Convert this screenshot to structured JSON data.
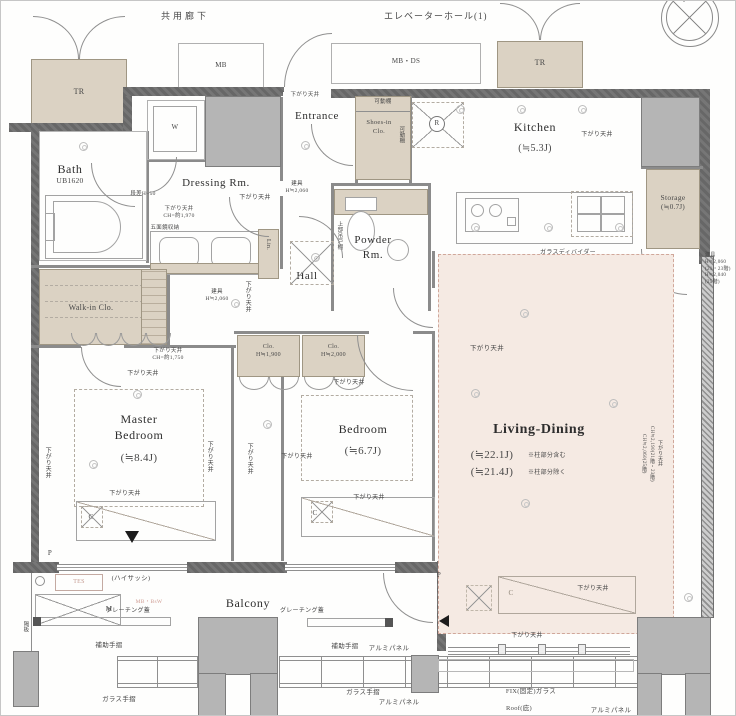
{
  "areas": {
    "common_corridor": "共用廊下",
    "elevator_hall": "エレベーターホール(1)"
  },
  "rooms": {
    "bath_name": "Bath",
    "bath_model": "UB1620",
    "dressing": "Dressing Rm.",
    "entrance": "Entrance",
    "shoes": "Shoes-in\nClo.",
    "powder": "Powder\nRm.",
    "hall": "Hall",
    "kitchen_name": "Kitchen",
    "kitchen_size": "(≒5.3J)",
    "storage_name": "Storage",
    "storage_size": "(≒0.7J)",
    "living_name": "Living-Dining",
    "living_size_incl": "(≒22.1J)",
    "living_note_incl": "※柱部分含む",
    "living_size_excl": "(≒21.4J)",
    "living_note_excl": "※柱部分除く",
    "master_name": "Master\nBedroom",
    "master_size": "(≒8.4J)",
    "bedroom_name": "Bedroom",
    "bedroom_size": "(≒6.7J)",
    "walkin": "Walk-in Clo.",
    "balcony": "Balcony",
    "clo_a": "Clo.\nH≒1,900",
    "clo_b": "Clo.\nH≒2,000"
  },
  "marks": {
    "tr": "TR",
    "mb": "MB",
    "mb_ds": "MB・DS",
    "w": "W",
    "r": "R",
    "m": "M",
    "c": "C",
    "p": "P",
    "tes": "TES",
    "lin": "Lin.",
    "mb_bsw": "MB・BsW"
  },
  "ann": {
    "sagari": "下がり天井",
    "sagari_ch1970": "下がり天井\nCH=約1,970",
    "sagari_ch1750": "下がり天井\nCH=約1,750",
    "gomenkyo": "五面鏡収納",
    "dansa": "段差H=50",
    "tategu_2060": "建具\nH≒2,060",
    "tategu_right": "建具\nH≒2,060\n(21・23階)\nH≒2,040\n(25階)",
    "sagari_right": "下がり天井\nCH≒2,190(21階・23階)\nCH≒2,060(25階)",
    "kadodana": "可動棚",
    "jobu_tsurido": "上部吊戸棚",
    "glass_divider": "ガラスディバイダー",
    "grating": "グレーチング蓋",
    "hojo_tesuri": "補助手摺",
    "glass_tesuri": "ガラス手摺",
    "alumi_panel": "アルミパネル",
    "fix_glass": "FIX(固定)ガラス",
    "roof": "Roof(庇)",
    "high_sash": "(ハイサッシ)",
    "kakuita": "隔板"
  }
}
